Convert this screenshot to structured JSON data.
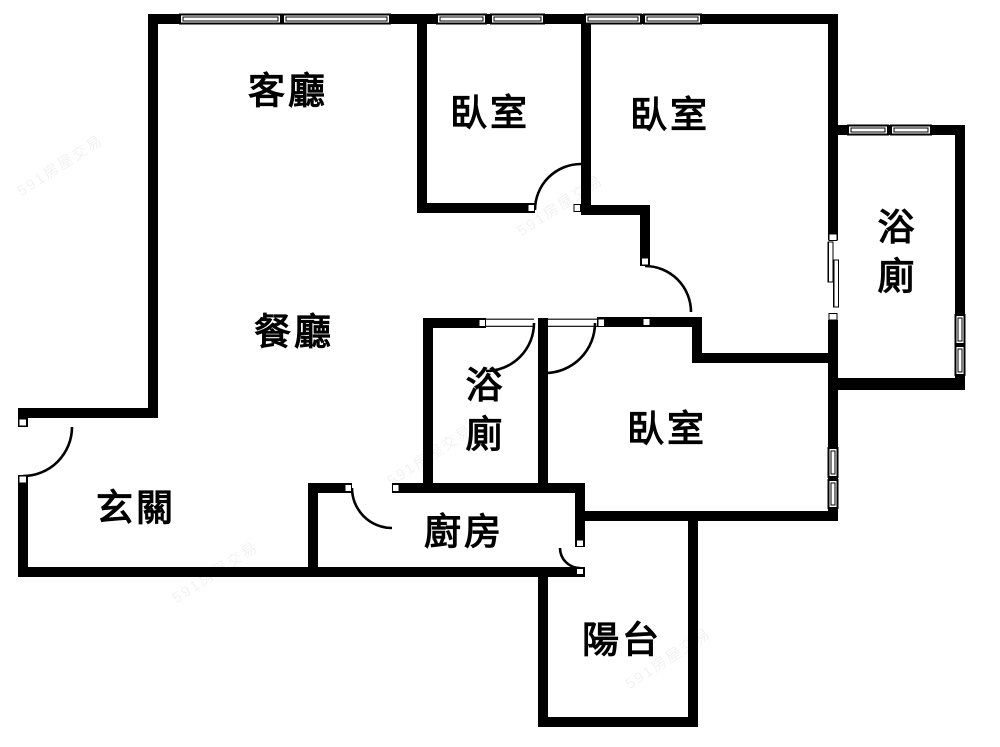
{
  "colors": {
    "wall": "#000000",
    "bg": "#ffffff",
    "wm": "rgba(0,0,0,0.055)"
  },
  "rooms": {
    "living": {
      "label": "客廳"
    },
    "bedroom1": {
      "label": "臥室"
    },
    "bedroom2": {
      "label": "臥室"
    },
    "bathroom1": {
      "label": "浴廁"
    },
    "dining": {
      "label": "餐廳"
    },
    "bathroom2": {
      "label": "浴廁"
    },
    "bedroom3": {
      "label": "臥室"
    },
    "entry": {
      "label": "玄關"
    },
    "kitchen": {
      "label": "廚房"
    },
    "balcony": {
      "label": "陽台"
    }
  },
  "watermark": {
    "text": "591房屋交易"
  },
  "symbols": {
    "swing_doors": 7,
    "sliding_doors": 1,
    "window_segments": 12
  }
}
